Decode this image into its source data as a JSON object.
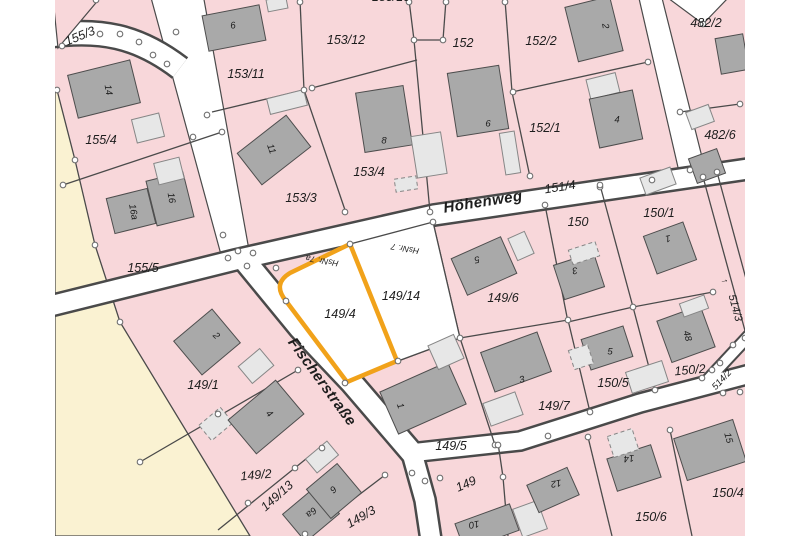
{
  "map": {
    "title": "Cadastral parcel map",
    "highlighted_parcel": "149/4",
    "colors": {
      "parcel_fill": "#f8d7da",
      "open_land_fill": "#faf2d2",
      "road_fill": "#ffffff",
      "boundary_line": "#4a4a4a",
      "building_dark": "#a9a9a9",
      "building_light": "#e7e7e7",
      "highlight_orange": "#f1a21a",
      "label_color": "#1d1d1d"
    },
    "street_labels": [
      {
        "t": "Höhenweg",
        "x": 483,
        "y": 202,
        "r": -9,
        "s": 15
      },
      {
        "t": "Fischerstraße",
        "x": 322,
        "y": 382,
        "r": 54,
        "s": 15
      }
    ],
    "parcel_labels": [
      {
        "t": "155/3",
        "x": 80,
        "y": 36,
        "r": -22
      },
      {
        "t": "155/4",
        "x": 101,
        "y": 140,
        "r": 0
      },
      {
        "t": "155/5",
        "x": 143,
        "y": 268,
        "r": 0
      },
      {
        "t": "153/11",
        "x": 246,
        "y": 74,
        "r": 0
      },
      {
        "t": "153/12",
        "x": 346,
        "y": 40,
        "r": 0
      },
      {
        "t": "153/10",
        "x": 391,
        "y": -3,
        "r": 0
      },
      {
        "t": "153/3",
        "x": 301,
        "y": 198,
        "r": 0
      },
      {
        "t": "153/4",
        "x": 369,
        "y": 172,
        "r": 0
      },
      {
        "t": "152",
        "x": 463,
        "y": 43,
        "r": 0
      },
      {
        "t": "152/2",
        "x": 541,
        "y": 41,
        "r": 0
      },
      {
        "t": "152/1",
        "x": 545,
        "y": 128,
        "r": 0
      },
      {
        "t": "482/2",
        "x": 706,
        "y": 23,
        "r": 0
      },
      {
        "t": "482/6",
        "x": 720,
        "y": 135,
        "r": 0
      },
      {
        "t": "151/4",
        "x": 560,
        "y": 187,
        "r": -9
      },
      {
        "t": "150",
        "x": 578,
        "y": 222,
        "r": 0
      },
      {
        "t": "150/1",
        "x": 659,
        "y": 213,
        "r": 0
      },
      {
        "t": "149/6",
        "x": 503,
        "y": 298,
        "r": 0
      },
      {
        "t": "149/14",
        "x": 401,
        "y": 296,
        "r": 0
      },
      {
        "t": "149/4",
        "x": 340,
        "y": 314,
        "r": 0
      },
      {
        "t": "149/7",
        "x": 554,
        "y": 406,
        "r": 0
      },
      {
        "t": "149/5",
        "x": 451,
        "y": 446,
        "r": 0
      },
      {
        "t": "149",
        "x": 466,
        "y": 484,
        "r": -24
      },
      {
        "t": "149/1",
        "x": 203,
        "y": 385,
        "r": 0
      },
      {
        "t": "149/2",
        "x": 256,
        "y": 475,
        "r": -5
      },
      {
        "t": "149/13",
        "x": 277,
        "y": 496,
        "r": -42
      },
      {
        "t": "149/3",
        "x": 361,
        "y": 517,
        "r": -30
      },
      {
        "t": "150/5",
        "x": 613,
        "y": 383,
        "r": 0
      },
      {
        "t": "150/2",
        "x": 690,
        "y": 370,
        "r": -5
      },
      {
        "t": "150/6",
        "x": 651,
        "y": 517,
        "r": 0
      },
      {
        "t": "150/4",
        "x": 728,
        "y": 493,
        "r": 0
      },
      {
        "t": "514/3",
        "x": 735,
        "y": 308,
        "r": 75,
        "s": 11
      },
      {
        "t": "514/2",
        "x": 722,
        "y": 380,
        "r": -47,
        "s": 9.5
      }
    ],
    "house_number_labels": [
      {
        "t": "14",
        "x": 108,
        "y": 90,
        "r": 80
      },
      {
        "t": "16a",
        "x": 133,
        "y": 212,
        "r": 80
      },
      {
        "t": "16",
        "x": 171,
        "y": 198,
        "r": 80
      },
      {
        "t": "6",
        "x": 233,
        "y": 26,
        "r": -10
      },
      {
        "t": "11",
        "x": 271,
        "y": 149,
        "r": 70
      },
      {
        "t": "8",
        "x": 384,
        "y": 141,
        "r": 0
      },
      {
        "t": "6",
        "x": 488,
        "y": 124,
        "r": 0
      },
      {
        "t": "2",
        "x": 605,
        "y": 26,
        "r": 80
      },
      {
        "t": "4",
        "x": 617,
        "y": 120,
        "r": 0
      },
      {
        "t": "5",
        "x": 477,
        "y": 259,
        "r": 170
      },
      {
        "t": "3",
        "x": 575,
        "y": 270,
        "r": 170
      },
      {
        "t": "1",
        "x": 668,
        "y": 238,
        "r": 170
      },
      {
        "t": "48",
        "x": 687,
        "y": 336,
        "r": 75
      },
      {
        "t": "5",
        "x": 610,
        "y": 352,
        "r": 0
      },
      {
        "t": "3",
        "x": 522,
        "y": 380,
        "r": -15
      },
      {
        "t": "1",
        "x": 400,
        "y": 406,
        "r": 70
      },
      {
        "t": "2",
        "x": 216,
        "y": 336,
        "r": 45
      },
      {
        "t": "4",
        "x": 269,
        "y": 414,
        "r": 45
      },
      {
        "t": "6a",
        "x": 311,
        "y": 512,
        "r": 140
      },
      {
        "t": "6",
        "x": 333,
        "y": 489,
        "r": 140
      },
      {
        "t": "10",
        "x": 474,
        "y": 524,
        "r": 170
      },
      {
        "t": "12",
        "x": 556,
        "y": 483,
        "r": 170
      },
      {
        "t": "14",
        "x": 629,
        "y": 458,
        "r": 175
      },
      {
        "t": "15",
        "x": 728,
        "y": 438,
        "r": 75
      }
    ],
    "annotation_labels": [
      {
        "t": "HsNr. 7a",
        "x": 322,
        "y": 261,
        "r": 190,
        "s": 8.5
      },
      {
        "t": "HsNr. 7",
        "x": 405,
        "y": 249,
        "r": 190,
        "s": 8.5
      },
      {
        "t": "↑",
        "x": 725,
        "y": 281,
        "r": 75,
        "s": 9
      }
    ]
  }
}
